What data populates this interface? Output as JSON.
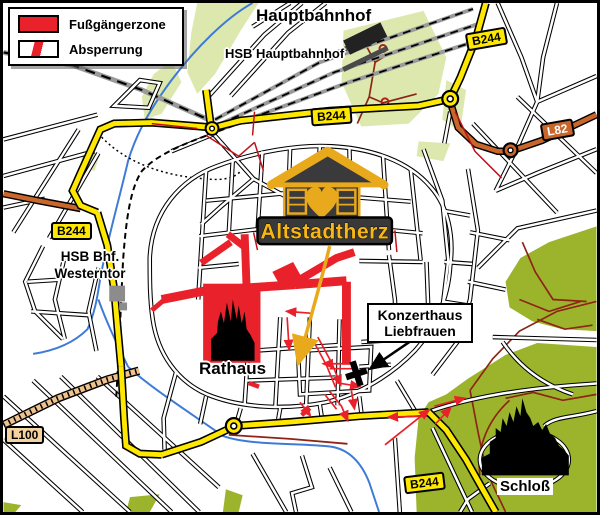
{
  "legend": {
    "items": [
      {
        "label": "Fußgängerzone",
        "swatch": "pedestrian-zone"
      },
      {
        "label": "Absperrung",
        "swatch": "barrier"
      }
    ]
  },
  "labels": {
    "hauptbahnhof": "Hauptbahnhof",
    "hsb_hauptbahnhof": "HSB Hauptbahnhof",
    "westerntor_line1": "HSB Bhf.",
    "westerntor_line2": "Westerntor",
    "rathaus": "Rathaus",
    "konzerthaus_line1": "Konzerthaus",
    "konzerthaus_line2": "Liebfrauen",
    "schloss": "Schloß",
    "altstadtherz": "Altstadtherz"
  },
  "badges": {
    "b244": "B244",
    "l82": "L82",
    "l100": "L100"
  },
  "colors": {
    "pedestrian_zone": "#E9212A",
    "road_primary_yellow": "#FFE800",
    "road_secondary_orange": "#C8662B",
    "road_tertiary_tan": "#EFC28E",
    "park_light": "#DCE8AE",
    "park_dark": "#9CB42C",
    "water": "#3E7BD6",
    "brand_gold": "#E8A91C",
    "brand_dark": "#3A3A3C"
  }
}
